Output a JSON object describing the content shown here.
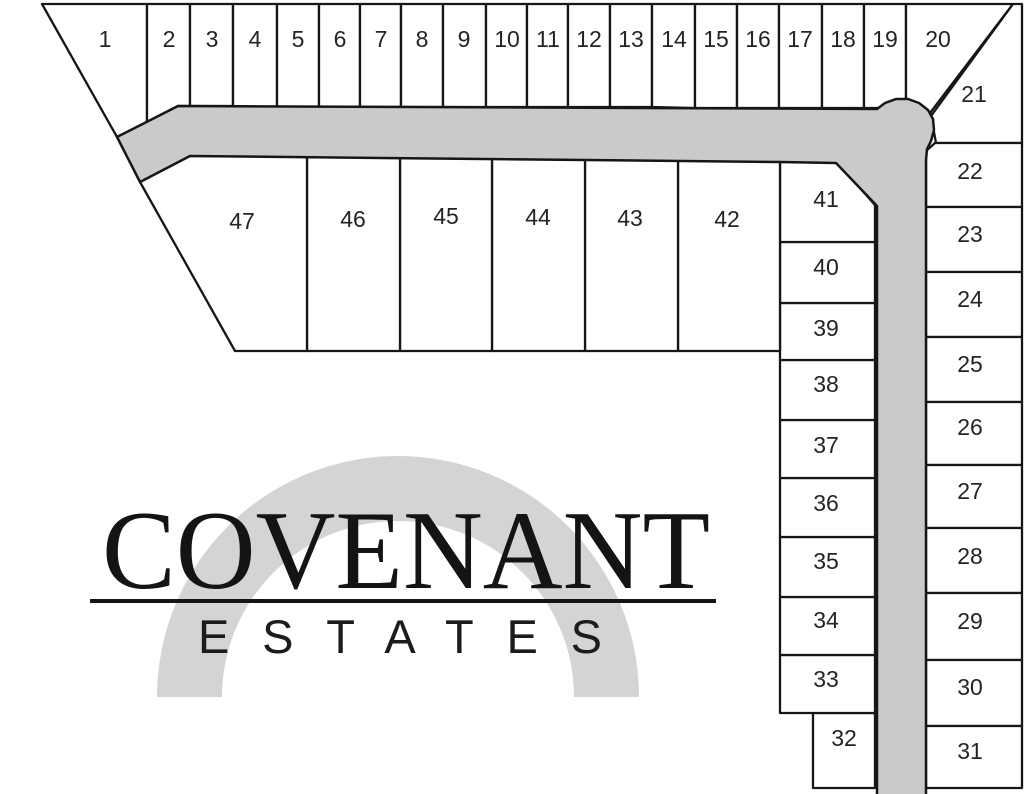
{
  "map_title": "Covenant Estates plat map",
  "canvas": {
    "width": 1024,
    "height": 794
  },
  "colors": {
    "background": "#ffffff",
    "road_fill": "#cacaca",
    "arch_fill": "#d4d4d4",
    "line": "#161616",
    "lot_fill": "#ffffff",
    "label": "#242424",
    "logo_text": "#141414"
  },
  "logo": {
    "title": "COVENANT",
    "subtitle": "ESTATES"
  },
  "road": {
    "points": "117,137 178,106 877,109 885,103 896,99 908,99 919,103 928,110 933,119 934,130 931,141 927,149 926,160 926,800 877,800 877,206 836,163 780,162 190,156 140,182"
  },
  "arch": {
    "cx": 398,
    "cy": 697,
    "outer_radius": 241,
    "inner_radius": 176
  },
  "lots": [
    {
      "n": "1",
      "points": "42,4 147,4 147,122 117,137",
      "lx": 105,
      "ly": 39
    },
    {
      "n": "2",
      "points": "147,4 190,4 190,106 178,106 147,122",
      "lx": 169,
      "ly": 39
    },
    {
      "n": "3",
      "points": "190,4 233,4 233,106 190,106",
      "lx": 212,
      "ly": 39
    },
    {
      "n": "4",
      "points": "233,4 277,4 277,107 233,106",
      "lx": 255,
      "ly": 39
    },
    {
      "n": "5",
      "points": "277,4 319,4 319,107 277,107",
      "lx": 298,
      "ly": 39
    },
    {
      "n": "6",
      "points": "319,4 360,4 360,107 319,107",
      "lx": 340,
      "ly": 39
    },
    {
      "n": "7",
      "points": "360,4 401,4 401,107 360,107",
      "lx": 381,
      "ly": 39
    },
    {
      "n": "8",
      "points": "401,4 443,4 443,107 401,107",
      "lx": 422,
      "ly": 39
    },
    {
      "n": "9",
      "points": "443,4 486,4 486,107 443,107",
      "lx": 464,
      "ly": 39
    },
    {
      "n": "10",
      "points": "486,4 527,4 527,107 486,107",
      "lx": 507,
      "ly": 39
    },
    {
      "n": "11",
      "points": "527,4 568,4 568,107 527,107",
      "lx": 548,
      "ly": 39
    },
    {
      "n": "12",
      "points": "568,4 610,4 610,107 568,107",
      "lx": 589,
      "ly": 39
    },
    {
      "n": "13",
      "points": "610,4 652,4 652,107 610,107",
      "lx": 631,
      "ly": 39
    },
    {
      "n": "14",
      "points": "652,4 695,4 695,108 652,107",
      "lx": 674,
      "ly": 39
    },
    {
      "n": "15",
      "points": "695,4 737,4 737,108 695,108",
      "lx": 716,
      "ly": 39
    },
    {
      "n": "16",
      "points": "737,4 779,4 779,108 737,108",
      "lx": 758,
      "ly": 39
    },
    {
      "n": "17",
      "points": "779,4 822,4 822,108 779,108",
      "lx": 800,
      "ly": 39
    },
    {
      "n": "18",
      "points": "822,4 864,4 864,108 822,108",
      "lx": 843,
      "ly": 39
    },
    {
      "n": "19",
      "points": "864,4 906,4 906,108 864,108",
      "lx": 885,
      "ly": 39
    },
    {
      "n": "20",
      "points": "906,4 1013,4 930,113 906,109",
      "lx": 938,
      "ly": 39
    },
    {
      "n": "21",
      "points": "1013,4 1022,4 1022,143 936,143 931,116",
      "lx": 974,
      "ly": 94
    },
    {
      "n": "22",
      "points": "935,143 1022,143 1022,207 926,207 926,151",
      "lx": 970,
      "ly": 171
    },
    {
      "n": "23",
      "points": "926,207 1022,207 1022,272 926,272",
      "lx": 970,
      "ly": 234
    },
    {
      "n": "24",
      "points": "926,272 1022,272 1022,337 926,337",
      "lx": 970,
      "ly": 299
    },
    {
      "n": "25",
      "points": "926,337 1022,337 1022,402 926,402",
      "lx": 970,
      "ly": 364
    },
    {
      "n": "26",
      "points": "926,402 1022,402 1022,465 926,465",
      "lx": 970,
      "ly": 427
    },
    {
      "n": "27",
      "points": "926,465 1022,465 1022,528 926,528",
      "lx": 970,
      "ly": 491
    },
    {
      "n": "28",
      "points": "926,528 1022,528 1022,593 926,593",
      "lx": 970,
      "ly": 556
    },
    {
      "n": "29",
      "points": "926,593 1022,593 1022,660 926,660",
      "lx": 970,
      "ly": 621
    },
    {
      "n": "30",
      "points": "926,660 1022,660 1022,726 926,726",
      "lx": 970,
      "ly": 687
    },
    {
      "n": "31",
      "points": "926,726 1022,726 1022,788 926,788",
      "lx": 970,
      "ly": 751
    },
    {
      "n": "32",
      "points": "813,713 875,713 875,788 813,788",
      "lx": 844,
      "ly": 738
    },
    {
      "n": "33",
      "points": "780,655 875,655 875,713 780,713",
      "lx": 826,
      "ly": 679
    },
    {
      "n": "34",
      "points": "780,597 875,597 875,655 780,655",
      "lx": 826,
      "ly": 620
    },
    {
      "n": "35",
      "points": "780,537 875,537 875,597 780,597",
      "lx": 826,
      "ly": 561
    },
    {
      "n": "36",
      "points": "780,478 875,478 875,537 780,537",
      "lx": 826,
      "ly": 503
    },
    {
      "n": "37",
      "points": "780,420 875,420 875,478 780,478",
      "lx": 826,
      "ly": 445
    },
    {
      "n": "38",
      "points": "780,360 875,360 875,420 780,420",
      "lx": 826,
      "ly": 384
    },
    {
      "n": "39",
      "points": "780,303 875,303 875,360 780,360",
      "lx": 826,
      "ly": 328
    },
    {
      "n": "40",
      "points": "780,242 875,242 875,303 780,303",
      "lx": 826,
      "ly": 267
    },
    {
      "n": "41",
      "points": "780,162 837,162 875,205 875,242 780,242",
      "lx": 826,
      "ly": 199
    },
    {
      "n": "42",
      "points": "678,160 780,161 780,351 678,351",
      "lx": 727,
      "ly": 219
    },
    {
      "n": "43",
      "points": "585,159 678,160 678,351 585,351",
      "lx": 630,
      "ly": 218
    },
    {
      "n": "44",
      "points": "492,158 585,159 585,351 492,351",
      "lx": 538,
      "ly": 217
    },
    {
      "n": "45",
      "points": "400,157 492,158 492,351 400,351",
      "lx": 446,
      "ly": 216
    },
    {
      "n": "46",
      "points": "307,156 400,157 400,351 307,351",
      "lx": 353,
      "ly": 219
    },
    {
      "n": "47",
      "points": "190,155 307,156 307,351 235,351 140,182",
      "lx": 242,
      "ly": 221
    }
  ]
}
